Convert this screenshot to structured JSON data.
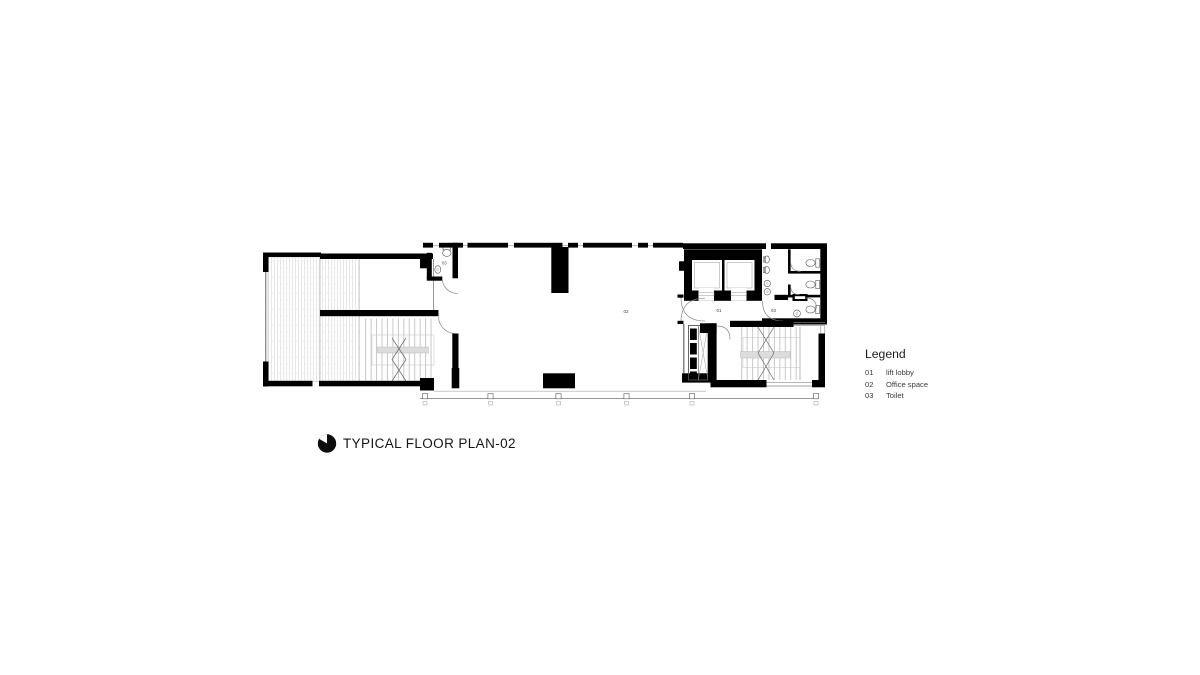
{
  "drawing": {
    "title": "TYPICAL FLOOR PLAN-02",
    "room_labels": {
      "office": "02",
      "lift_lobby": "01",
      "toilet_right": "03",
      "toilet_left": "03"
    }
  },
  "legend": {
    "title": "Legend",
    "items": [
      {
        "code": "01",
        "label": "lift lobby"
      },
      {
        "code": "02",
        "label": "Office space"
      },
      {
        "code": "03",
        "label": "Toilet"
      }
    ]
  },
  "colors": {
    "ink": "#000000",
    "paper": "#ffffff"
  }
}
